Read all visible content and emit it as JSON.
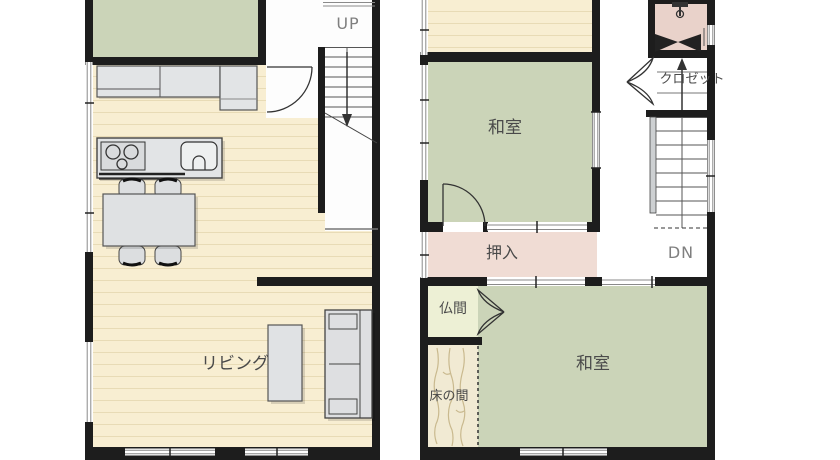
{
  "floor1": {
    "up_label": "UP",
    "living_label": "リビング"
  },
  "floor2": {
    "washitsu_top_label": "和室",
    "closet_label": "クロゼット",
    "oshiire_label": "押入",
    "dn_label": "DN",
    "butsuma_label": "仏間",
    "tokonoma_label": "床の間",
    "washitsu_bottom_label": "和室"
  },
  "colors": {
    "wall": "#1d1d1d",
    "tatami_green": "#cbd4b8",
    "wood_floor": "#f8eed2",
    "floor_stripe": "#e8dbb6",
    "oshiire_pink": "#f0dcd4",
    "toilet_pink": "#e9d2ca",
    "butsuma_cream": "#edf0d5",
    "tokonoma_beige": "#f1ead3",
    "furniture_grey": "#e0e2e4",
    "label_grey": "#4a4a4a",
    "stair_label_grey": "#7f7f7f"
  }
}
